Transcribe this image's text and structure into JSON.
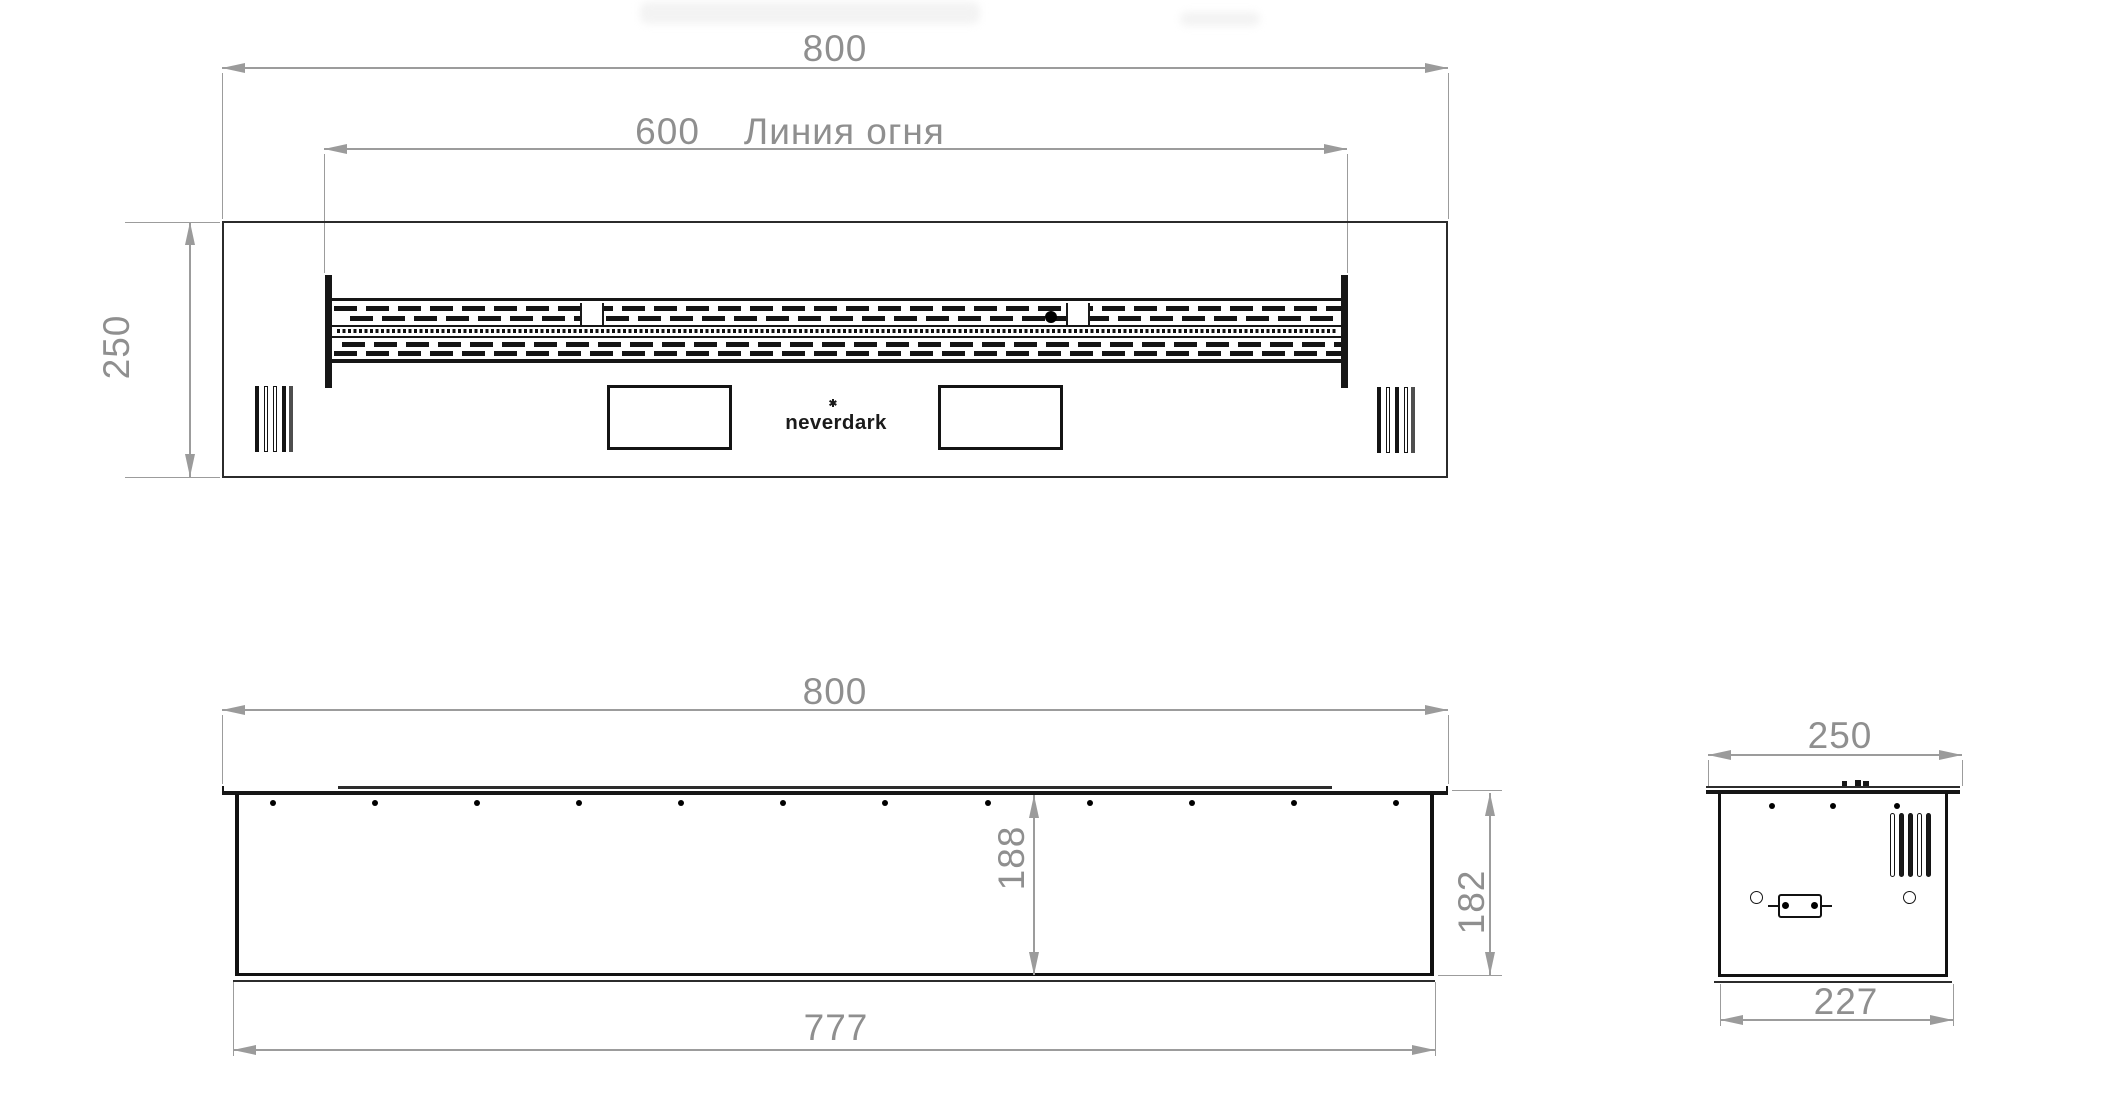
{
  "drawing": {
    "brand": "neverdark",
    "views": {
      "top": {
        "width": "800",
        "fire_line_value": "600",
        "fire_line_label": "Линия огня",
        "depth": "250"
      },
      "front": {
        "width": "800",
        "inner_height": "188",
        "height": "182",
        "bottom_width": "777"
      },
      "side": {
        "depth": "250",
        "bottom_width": "227"
      }
    },
    "colors": {
      "background": "#ffffff",
      "line": "#161616",
      "dimension": "#8f8f8f"
    }
  }
}
